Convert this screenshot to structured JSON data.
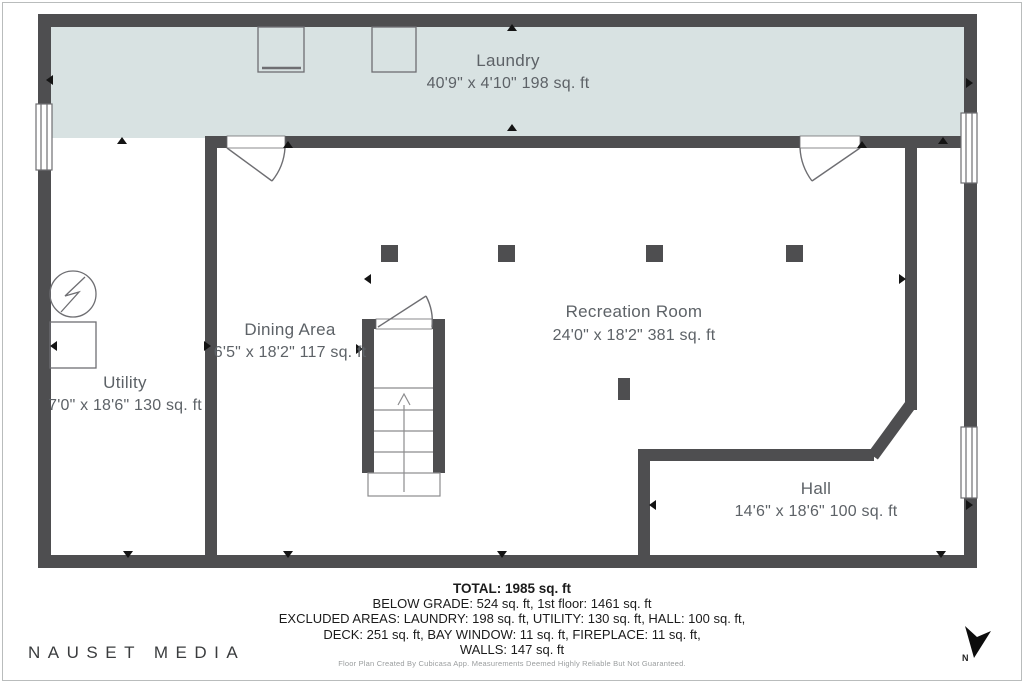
{
  "rooms": {
    "laundry": {
      "name": "Laundry",
      "dims": "40'9\" x 4'10\" 198 sq. ft"
    },
    "dining": {
      "name": "Dining Area",
      "dims": "6'5\" x 18'2\" 117 sq. ft"
    },
    "recreation": {
      "name": "Recreation Room",
      "dims": "24'0\" x 18'2\" 381 sq. ft"
    },
    "utility": {
      "name": "Utility",
      "dims": "7'0\" x 18'6\" 130 sq. ft"
    },
    "hall": {
      "name": "Hall",
      "dims": "14'6\" x 18'6\" 100 sq. ft"
    }
  },
  "summary": {
    "total": "TOTAL: 1985 sq. ft",
    "line2": "BELOW GRADE: 524 sq. ft, 1st floor: 1461 sq. ft",
    "line3": "EXCLUDED AREAS: LAUNDRY: 198 sq. ft, UTILITY: 130 sq. ft, HALL: 100 sq. ft,",
    "line4": "DECK: 251 sq. ft, BAY WINDOW: 11 sq. ft, FIREPLACE: 11 sq. ft,",
    "line5": "WALLS: 147 sq. ft",
    "disclaimer": "Floor Plan Created By Cubicasa App. Measurements Deemed Highly Reliable But Not Guaranteed."
  },
  "branding": {
    "studio": "NAUSET MEDIA"
  },
  "compass": {
    "north_label": "N"
  },
  "colors": {
    "wall": "#4e4e50",
    "laundry_fill": "#d8e2e2",
    "outline": "#6e6e72",
    "stair_line": "#8c8c8e",
    "marker": "#141414",
    "label_text": "#5d6267"
  }
}
